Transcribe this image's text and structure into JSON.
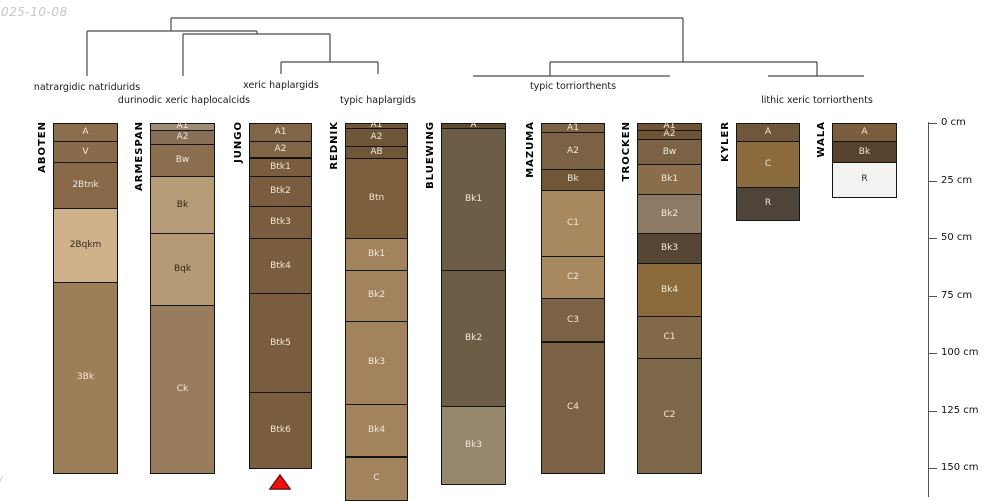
{
  "watermark": {
    "date_fragment": "025-10-08",
    "bottom_fragment": "/"
  },
  "chart_data": {
    "type": "soil-profile-columns-with-dendrogram",
    "depth_axis": {
      "unit": "cm",
      "ticks_cm": [
        0,
        25,
        50,
        75,
        100,
        125,
        150
      ],
      "tick_labels": [
        "0 cm",
        "25 cm",
        "50 cm",
        "75 cm",
        "100 cm",
        "125 cm",
        "150 cm"
      ],
      "x": 928,
      "top_y": 122,
      "bottom_y": 497,
      "y0": 123,
      "px_per_cm": 2.3,
      "tick_len": 9,
      "label_x": 941
    },
    "group_labels": [
      {
        "text": "natrargidic natridurids",
        "x": 87,
        "y": 82
      },
      {
        "text": "durinodic xeric haplocalcids",
        "x": 184,
        "y": 95
      },
      {
        "text": "xeric haplargids",
        "x": 281,
        "y": 80
      },
      {
        "text": "typic haplargids",
        "x": 378,
        "y": 95
      },
      {
        "text": "typic torriorthents",
        "x": 573,
        "y": 81
      },
      {
        "text": "lithic xeric torriorthents",
        "x": 817,
        "y": 95
      }
    ],
    "dendrogram": {
      "line_color": "#4a4a4a",
      "segments": [
        {
          "x1": 171,
          "y1": 18,
          "x2": 683,
          "y2": 18
        },
        {
          "x1": 171,
          "y1": 18,
          "x2": 171,
          "y2": 31
        },
        {
          "x1": 683,
          "y1": 18,
          "x2": 683,
          "y2": 62
        },
        {
          "x1": 87,
          "y1": 31,
          "x2": 257,
          "y2": 31
        },
        {
          "x1": 87,
          "y1": 31,
          "x2": 87,
          "y2": 76
        },
        {
          "x1": 257,
          "y1": 31,
          "x2": 257,
          "y2": 34
        },
        {
          "x1": 183,
          "y1": 34,
          "x2": 330,
          "y2": 34
        },
        {
          "x1": 183,
          "y1": 34,
          "x2": 183,
          "y2": 76
        },
        {
          "x1": 330,
          "y1": 34,
          "x2": 330,
          "y2": 62
        },
        {
          "x1": 281,
          "y1": 62,
          "x2": 378,
          "y2": 62
        },
        {
          "x1": 281,
          "y1": 62,
          "x2": 281,
          "y2": 74
        },
        {
          "x1": 378,
          "y1": 62,
          "x2": 378,
          "y2": 74
        },
        {
          "x1": 550,
          "y1": 62,
          "x2": 817,
          "y2": 62
        },
        {
          "x1": 550,
          "y1": 62,
          "x2": 550,
          "y2": 76
        },
        {
          "x1": 817,
          "y1": 62,
          "x2": 817,
          "y2": 76
        },
        {
          "x1": 473,
          "y1": 76,
          "x2": 670,
          "y2": 76
        },
        {
          "x1": 768,
          "y1": 76,
          "x2": 864,
          "y2": 76
        }
      ]
    },
    "marker": {
      "shape": "triangle-up",
      "fill": "#ee1111",
      "stroke": "#7c0a0a",
      "cx": 280,
      "apex_y": 475,
      "base_y": 490,
      "half_width": 10
    },
    "text_colors": {
      "light": "#f0e9d8",
      "dark": "#33281b"
    },
    "profiles": [
      {
        "name": "ABOTEN",
        "x": 53,
        "width": 65,
        "horizons": [
          {
            "label": "A",
            "top": 0,
            "bottom": 8,
            "color": "#8a6e4e",
            "text": "light"
          },
          {
            "label": "V",
            "top": 8,
            "bottom": 17,
            "color": "#876b4b",
            "text": "light"
          },
          {
            "label": "2Btnk",
            "top": 17,
            "bottom": 37,
            "color": "#87694a",
            "text": "light"
          },
          {
            "label": "2Bqkm",
            "top": 37,
            "bottom": 69,
            "color": "#cfb28c",
            "text": "dark"
          },
          {
            "label": "3Bk",
            "top": 69,
            "bottom": 152,
            "color": "#9c7e58",
            "text": "light"
          }
        ]
      },
      {
        "name": "ARMESPAN",
        "x": 150,
        "width": 65,
        "horizons": [
          {
            "label": "A1",
            "top": 0,
            "bottom": 3,
            "color": "#9e8d76",
            "text": "light"
          },
          {
            "label": "A2",
            "top": 3,
            "bottom": 9,
            "color": "#877057",
            "text": "light"
          },
          {
            "label": "Bw",
            "top": 9,
            "bottom": 23,
            "color": "#8a6e4e",
            "text": "light"
          },
          {
            "label": "Bk",
            "top": 23,
            "bottom": 48,
            "color": "#b59b77",
            "text": "dark"
          },
          {
            "label": "Bqk",
            "top": 48,
            "bottom": 79,
            "color": "#b49a75",
            "text": "dark"
          },
          {
            "label": "Ck",
            "top": 79,
            "bottom": 152,
            "color": "#997b5d",
            "text": "light"
          }
        ]
      },
      {
        "name": "JUNGO",
        "x": 249,
        "width": 63,
        "horizons": [
          {
            "label": "A1",
            "top": 0,
            "bottom": 8,
            "color": "#816547",
            "text": "light"
          },
          {
            "label": "A2",
            "top": 8,
            "bottom": 15,
            "color": "#816547",
            "text": "light"
          },
          {
            "label": "Btk1",
            "top": 15,
            "bottom": 23,
            "color": "#7a5d3e",
            "text": "light"
          },
          {
            "label": "Btk2",
            "top": 23,
            "bottom": 36,
            "color": "#7a5d3e",
            "text": "light"
          },
          {
            "label": "Btk3",
            "top": 36,
            "bottom": 50,
            "color": "#7a5d3e",
            "text": "light"
          },
          {
            "label": "Btk4",
            "top": 50,
            "bottom": 74,
            "color": "#7a5d3e",
            "text": "light"
          },
          {
            "label": "Btk5",
            "top": 74,
            "bottom": 117,
            "color": "#7a5d3e",
            "text": "light"
          },
          {
            "label": "Btk6",
            "top": 117,
            "bottom": 150,
            "color": "#7a5d3e",
            "text": "light"
          }
        ]
      },
      {
        "name": "REDNIK",
        "x": 345,
        "width": 63,
        "horizons": [
          {
            "label": "A1",
            "top": 0,
            "bottom": 2,
            "color": "#6e5638",
            "text": "light"
          },
          {
            "label": "A2",
            "top": 2,
            "bottom": 10,
            "color": "#6e5638",
            "text": "light"
          },
          {
            "label": "AB",
            "top": 10,
            "bottom": 15,
            "color": "#6e5638",
            "text": "light"
          },
          {
            "label": "Btn",
            "top": 15,
            "bottom": 50,
            "color": "#7d5f3d",
            "text": "light"
          },
          {
            "label": "Bk1",
            "top": 50,
            "bottom": 64,
            "color": "#a3825e",
            "text": "light"
          },
          {
            "label": "Bk2",
            "top": 64,
            "bottom": 86,
            "color": "#a3825e",
            "text": "light"
          },
          {
            "label": "Bk3",
            "top": 86,
            "bottom": 122,
            "color": "#a3825e",
            "text": "light"
          },
          {
            "label": "Bk4",
            "top": 122,
            "bottom": 145,
            "color": "#a3825e",
            "text": "light"
          },
          {
            "label": "C",
            "top": 145,
            "bottom": 164,
            "color": "#a3825e",
            "text": "light"
          }
        ]
      },
      {
        "name": "BLUEWING",
        "x": 441,
        "width": 65,
        "horizons": [
          {
            "label": "A",
            "top": 0,
            "bottom": 2,
            "color": "#5c4a33",
            "text": "light"
          },
          {
            "label": "Bk1",
            "top": 2,
            "bottom": 64,
            "color": "#6c5e46",
            "text": "light"
          },
          {
            "label": "Bk2",
            "top": 64,
            "bottom": 123,
            "color": "#6c5e46",
            "text": "light"
          },
          {
            "label": "Bk3",
            "top": 123,
            "bottom": 157,
            "color": "#96886c",
            "text": "light"
          }
        ]
      },
      {
        "name": "MAZUMA",
        "x": 541,
        "width": 64,
        "horizons": [
          {
            "label": "A1",
            "top": 0,
            "bottom": 4,
            "color": "#7c6244",
            "text": "light"
          },
          {
            "label": "A2",
            "top": 4,
            "bottom": 20,
            "color": "#7c6244",
            "text": "light"
          },
          {
            "label": "Bk",
            "top": 20,
            "bottom": 29,
            "color": "#6f5738",
            "text": "light"
          },
          {
            "label": "C1",
            "top": 29,
            "bottom": 58,
            "color": "#a8895f",
            "text": "light"
          },
          {
            "label": "C2",
            "top": 58,
            "bottom": 76,
            "color": "#a8895f",
            "text": "light"
          },
          {
            "label": "C3",
            "top": 76,
            "bottom": 95,
            "color": "#7c6244",
            "text": "light"
          },
          {
            "label": "C4",
            "top": 95,
            "bottom": 152,
            "color": "#7c6244",
            "text": "light"
          }
        ]
      },
      {
        "name": "TROCKEN",
        "x": 637,
        "width": 65,
        "horizons": [
          {
            "label": "A1",
            "top": 0,
            "bottom": 3,
            "color": "#6e5435",
            "text": "light"
          },
          {
            "label": "A2",
            "top": 3,
            "bottom": 7,
            "color": "#6e5435",
            "text": "light"
          },
          {
            "label": "Bw",
            "top": 7,
            "bottom": 18,
            "color": "#7c6244",
            "text": "light"
          },
          {
            "label": "Bk1",
            "top": 18,
            "bottom": 31,
            "color": "#8a6d4a",
            "text": "light"
          },
          {
            "label": "Bk2",
            "top": 31,
            "bottom": 48,
            "color": "#8d7a64",
            "text": "light"
          },
          {
            "label": "Bk3",
            "top": 48,
            "bottom": 61,
            "color": "#584635",
            "text": "light"
          },
          {
            "label": "Bk4",
            "top": 61,
            "bottom": 84,
            "color": "#8b6b3c",
            "text": "light"
          },
          {
            "label": "C1",
            "top": 84,
            "bottom": 102,
            "color": "#83694a",
            "text": "light"
          },
          {
            "label": "C2",
            "top": 102,
            "bottom": 152,
            "color": "#7d6749",
            "text": "light"
          }
        ]
      },
      {
        "name": "KYLER",
        "x": 736,
        "width": 64,
        "horizons": [
          {
            "label": "A",
            "top": 0,
            "bottom": 8,
            "color": "#6f5839",
            "text": "light"
          },
          {
            "label": "C",
            "top": 8,
            "bottom": 28,
            "color": "#8b6b3c",
            "text": "light"
          },
          {
            "label": "R",
            "top": 28,
            "bottom": 42,
            "color": "#4e443a",
            "text": "light"
          }
        ]
      },
      {
        "name": "WALA",
        "x": 832,
        "width": 65,
        "horizons": [
          {
            "label": "A",
            "top": 0,
            "bottom": 8,
            "color": "#7a5e3e",
            "text": "light"
          },
          {
            "label": "Bk",
            "top": 8,
            "bottom": 17,
            "color": "#56432d",
            "text": "light"
          },
          {
            "label": "R",
            "top": 17,
            "bottom": 32,
            "color": "#f3f3f1",
            "text": "dark"
          }
        ]
      }
    ]
  }
}
